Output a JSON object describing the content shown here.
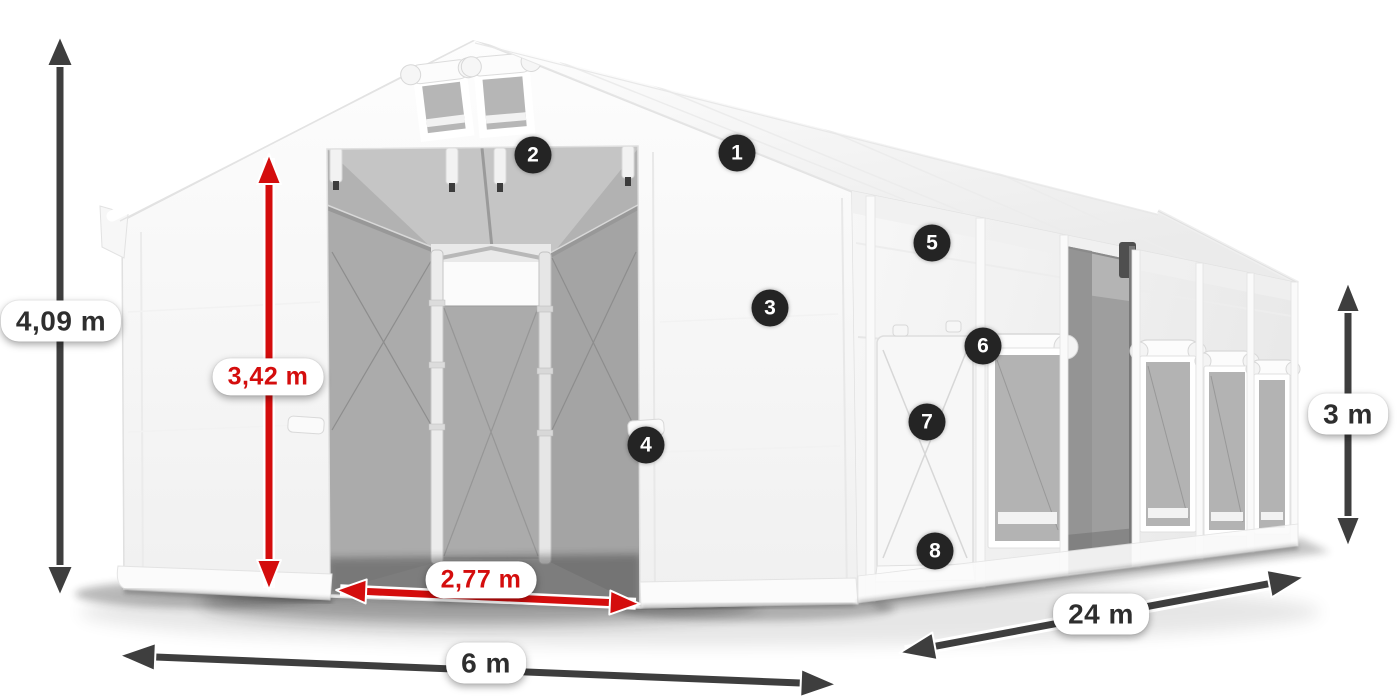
{
  "scene": {
    "description": "Product illustration of a white 6 x 24 m storage tent with dimension arrows and numbered feature markers",
    "background_color": "#ffffff",
    "colors": {
      "dimension_dark": "#3e3e3e",
      "dimension_red": "#d40d0d",
      "pill_background": "#ffffff",
      "pill_text_dark": "#2e2e2e",
      "badge_background": "#242424",
      "badge_text": "#ffffff"
    }
  },
  "dimensions": {
    "total_height": {
      "label": "4,09 m",
      "style": "dark"
    },
    "inner_height": {
      "label": "3,42 m",
      "style": "red"
    },
    "door_width": {
      "label": "2,77 m",
      "style": "red"
    },
    "gable_width": {
      "label": "6 m",
      "style": "dark"
    },
    "length": {
      "label": "24 m",
      "style": "dark"
    },
    "side_height": {
      "label": "3 m",
      "style": "dark"
    }
  },
  "markers": [
    {
      "number": "1"
    },
    {
      "number": "2"
    },
    {
      "number": "3"
    },
    {
      "number": "4"
    },
    {
      "number": "5"
    },
    {
      "number": "6"
    },
    {
      "number": "7"
    },
    {
      "number": "8"
    }
  ]
}
